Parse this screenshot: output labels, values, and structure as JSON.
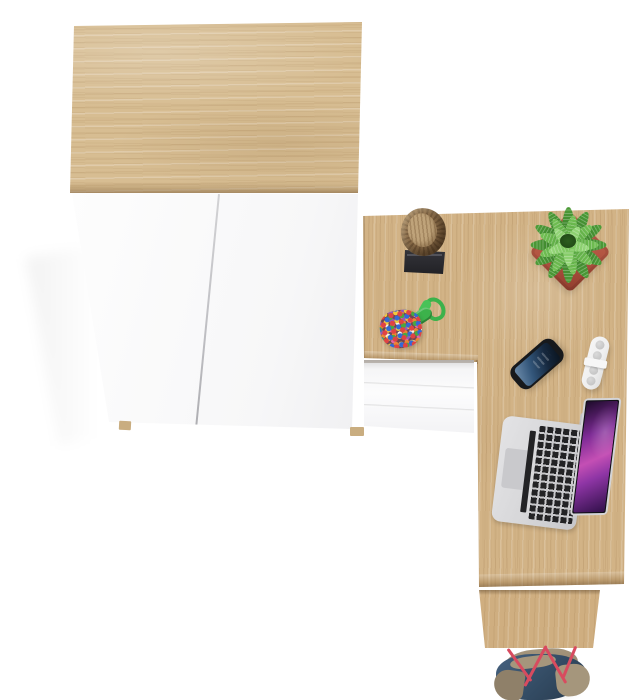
{
  "scene": {
    "kind": "top-down product render",
    "width": 643,
    "height": 700,
    "objects": [
      "wardrobe",
      "desk",
      "drawer-unit",
      "log-vase",
      "desk-mat",
      "potted-plant",
      "bead-keychain",
      "smartphone",
      "cable-organizer",
      "laptop",
      "desk-leg-panel",
      "tote-bag"
    ]
  },
  "colors": {
    "background": "#ffffff",
    "oak_top": "#d7bd92",
    "oak_desk": "#d2b386",
    "oak_leg": "#cfae80",
    "foot_oak": "#c9ad80",
    "white_panel": "#fdfdfd",
    "seam_gray": "#c2c2c6",
    "drawer_white": "#fcfcfd",
    "drawer_shadow": "#d9d9db",
    "mat_black": "#222226",
    "log_bark": "#8a6c49",
    "log_top": "#bfa37a",
    "pot_red": "#b25441",
    "pot_red_dark": "#8f3c2d",
    "leaf_dark": "#2f7022",
    "leaf_mid": "#4d9c38",
    "leaf_light": "#74c155",
    "cord_green": "#3cb24b",
    "pouch_base": "#6f4652",
    "bead_1": "#e04343",
    "bead_2": "#3468d6",
    "bead_3": "#f2c93c",
    "bead_4": "#4aa83f",
    "bead_5": "#9857b8",
    "bead_6": "#f5f2ea",
    "bead_7": "#ef8432",
    "bead_8": "#e467a4",
    "phone_body": "#17191c",
    "phone_screen_light": "#6d8cab",
    "phone_screen_dark": "#0a141f",
    "organizer_white": "#efefef",
    "organizer_hole": "#bdbdbd",
    "laptop_silver": "#d7d7d9",
    "laptop_key": "#232325",
    "screen_magenta": "#c44fb4",
    "screen_purple": "#7e2b96",
    "screen_dark": "#1d0b2a",
    "bag_blue": "#46627f",
    "bag_blue_dark": "#27394c",
    "bag_khaki": "#8f8069",
    "bag_khaki_light": "#a5967c",
    "strap_red": "#d84b5f"
  }
}
